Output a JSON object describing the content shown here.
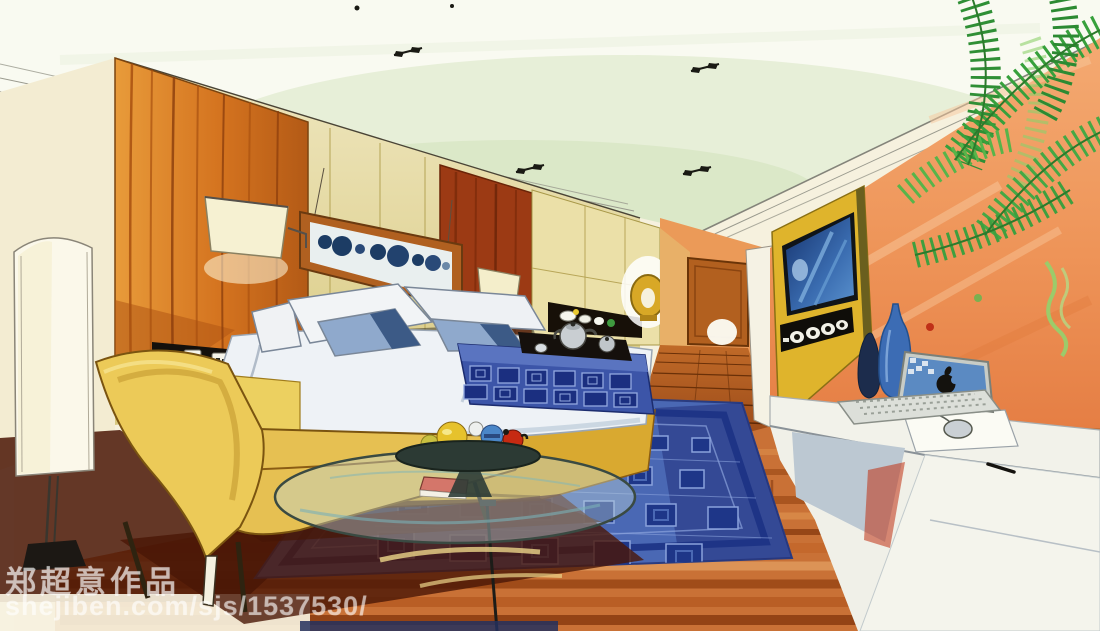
{
  "image": {
    "type": "hand-drawn marker interior rendering",
    "scene": "hotel bedroom in one-point perspective: platform bed with tea tray, chaise lounge, round glass coffee table with fruit bowl, blue patterned rug, wood headboard wall, hallway with door, peach TV wall with wall-mounted screen and speakers, white writing desk with laptop, palm plant"
  },
  "watermark": {
    "artist_line": "郑超意作品",
    "url_line": "shejiben.com/sjs/1537530/"
  },
  "palette": {
    "paper": "#f6f1de",
    "ceiling-green": "#dfe9cd",
    "wood-orange": "#d4731f",
    "wall-khaki": "#e2d494",
    "wall-peach": "#ef9a62",
    "rug-blue": "#4a68b4",
    "rug-navy": "#1e3688",
    "furniture-yellow": "#e6c052",
    "bed-white": "#eef2f6",
    "pillow-blue": "#8fa9cc",
    "screen-blue": "#4d84c4",
    "tv-panel-yellow": "#dfb42c",
    "floor-wood": "#c97136",
    "shadow-maroon": "#4a1606",
    "plant-green": "#3f9f3f",
    "desk-white": "#f2f2ea"
  },
  "scene_objects": [
    "ceiling recessed spotlights",
    "floor lamp",
    "wood headboard panel",
    "wall art with circles",
    "wall lamps",
    "power outlets",
    "bed with pillows",
    "patterned bed runner",
    "tea tray with silver pots",
    "chaise lounge",
    "glass coffee table",
    "fruit bowl",
    "blue patterned rug",
    "hallway with wooden door",
    "tv wall unit with speakers",
    "white writing desk",
    "laptop with apple logo",
    "mouse and mouse pad",
    "decorative bottles",
    "gold ring vase",
    "display niche with bowls",
    "palm plant"
  ]
}
